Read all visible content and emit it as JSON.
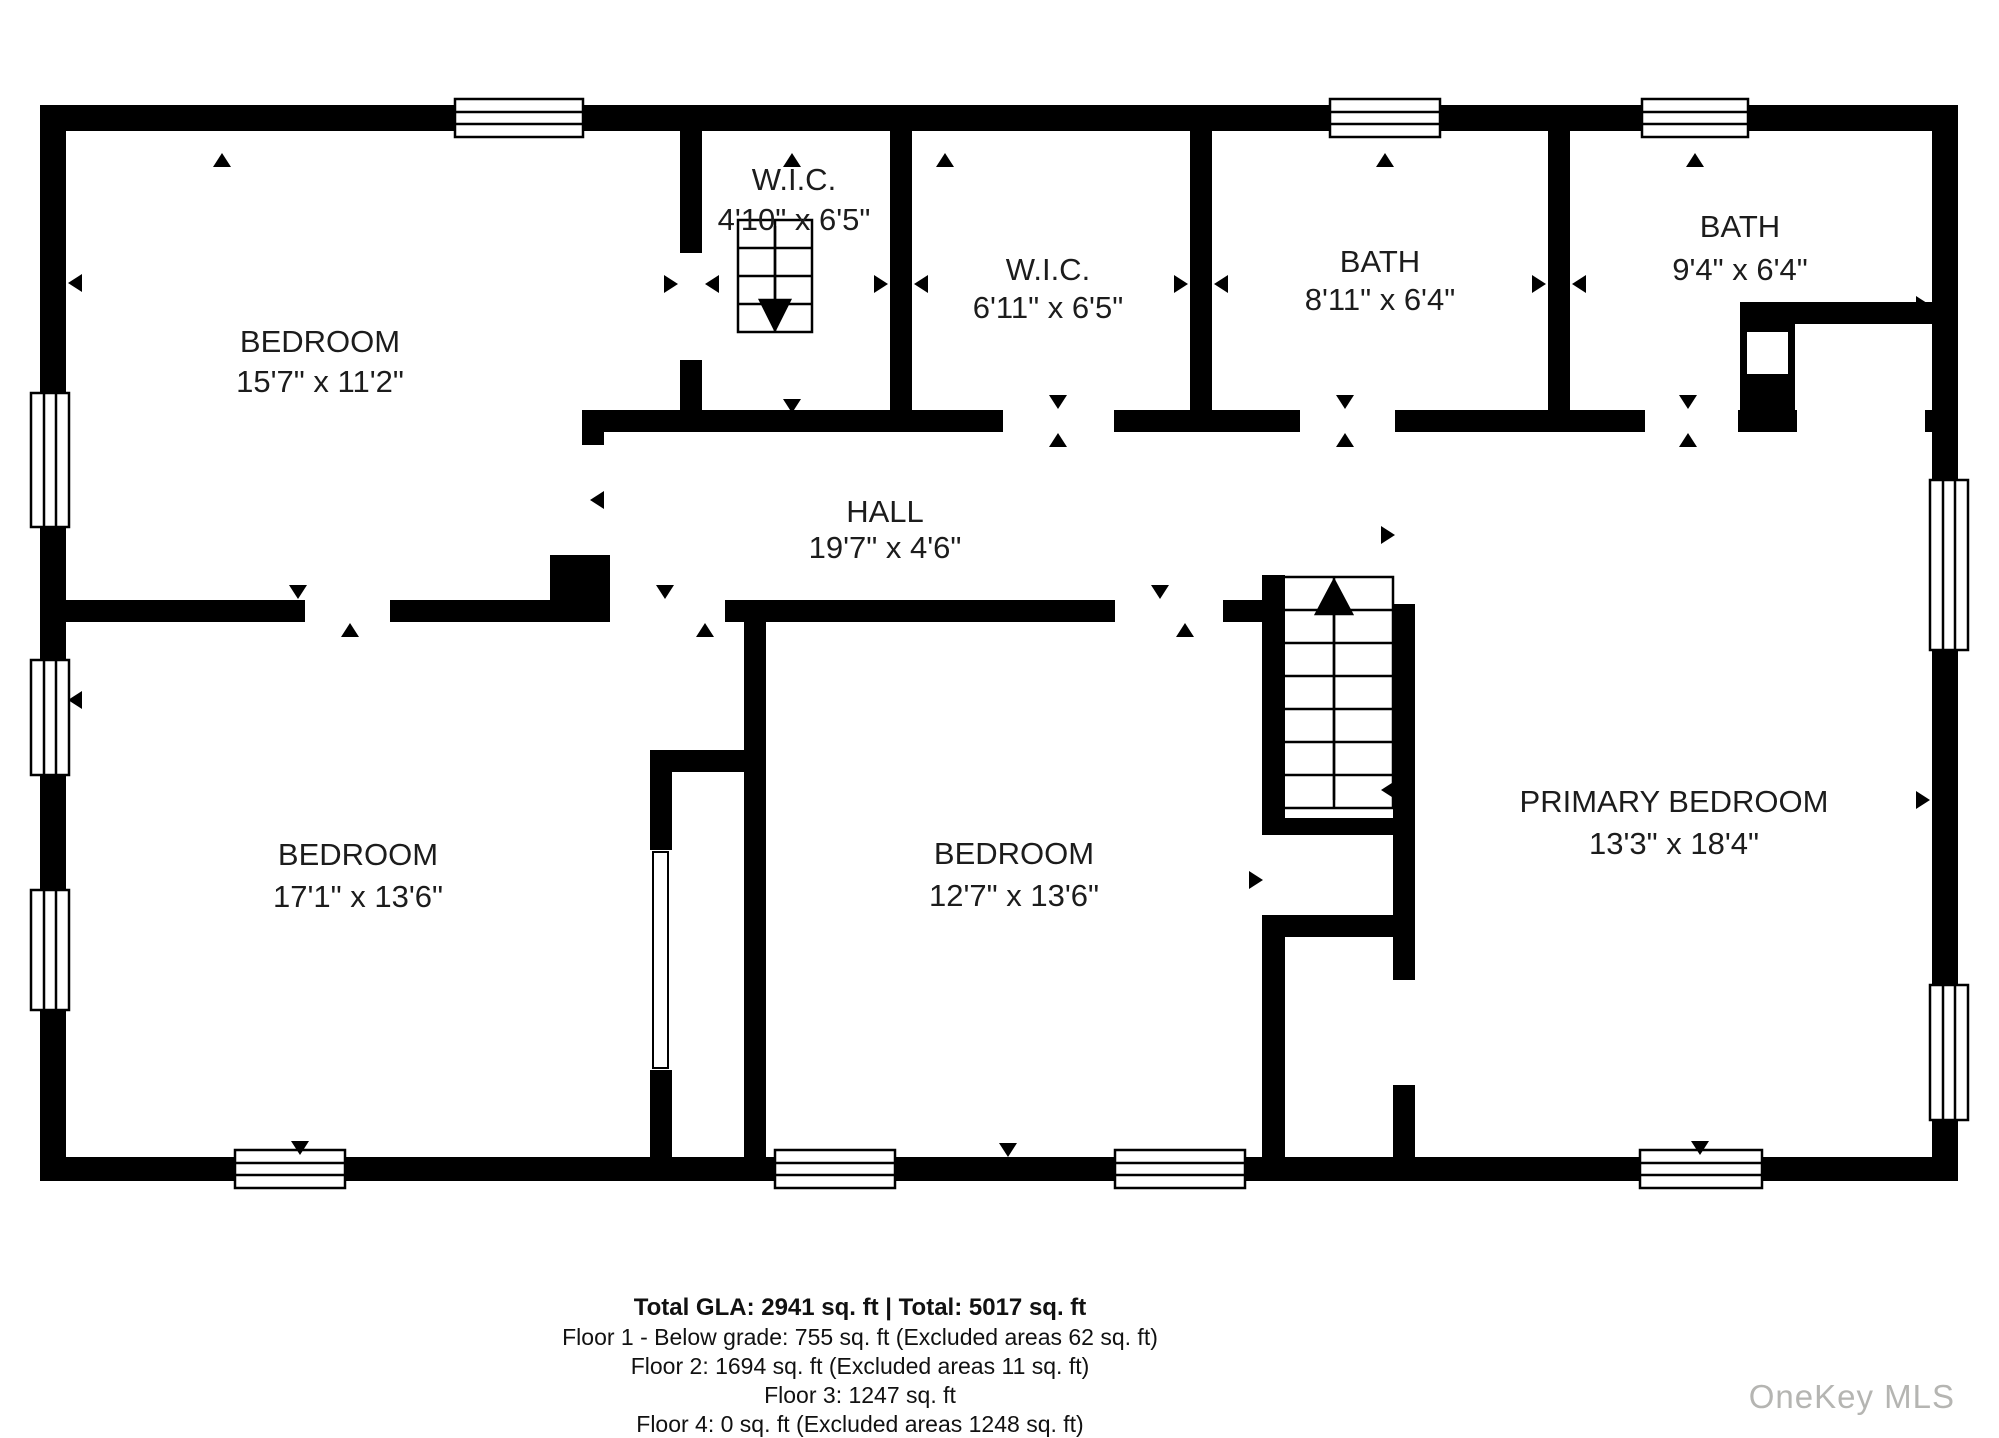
{
  "plan": {
    "rooms": [
      {
        "name": "bedroom-top-left",
        "label": "BEDROOM",
        "dims": "15'7\" x 11'2\""
      },
      {
        "name": "wic-stairs",
        "label": "W.I.C.",
        "dims": "4'10\" x 6'5\""
      },
      {
        "name": "wic",
        "label": "W.I.C.",
        "dims": "6'11\" x 6'5\""
      },
      {
        "name": "bath-left",
        "label": "BATH",
        "dims": "8'11\" x 6'4\""
      },
      {
        "name": "bath-right",
        "label": "BATH",
        "dims": "9'4\" x 6'4\""
      },
      {
        "name": "hall",
        "label": "HALL",
        "dims": "19'7\" x 4'6\""
      },
      {
        "name": "bedroom-bottom-left",
        "label": "BEDROOM",
        "dims": "17'1\" x 13'6\""
      },
      {
        "name": "bedroom-middle",
        "label": "BEDROOM",
        "dims": "12'7\" x 13'6\""
      },
      {
        "name": "primary-bedroom",
        "label": "PRIMARY BEDROOM",
        "dims": "13'3\" x 18'4\""
      }
    ],
    "stair_icons": [
      "staircase-down",
      "staircase-up"
    ]
  },
  "footer": {
    "line1": "Total GLA: 2941 sq. ft | Total: 5017 sq. ft",
    "line2": "Floor 1 - Below grade: 755 sq. ft (Excluded areas 62 sq. ft)",
    "line3": "Floor 2: 1694 sq. ft (Excluded areas 11 sq. ft)",
    "line4": "Floor 3: 1247 sq. ft",
    "line5": "Floor 4: 0 sq. ft (Excluded areas 1248 sq. ft)"
  },
  "watermark": "OneKey MLS",
  "colors": {
    "wall": "#000000",
    "background": "#ffffff",
    "label": "#1c1c1c",
    "watermark": "#b5b5b2"
  }
}
